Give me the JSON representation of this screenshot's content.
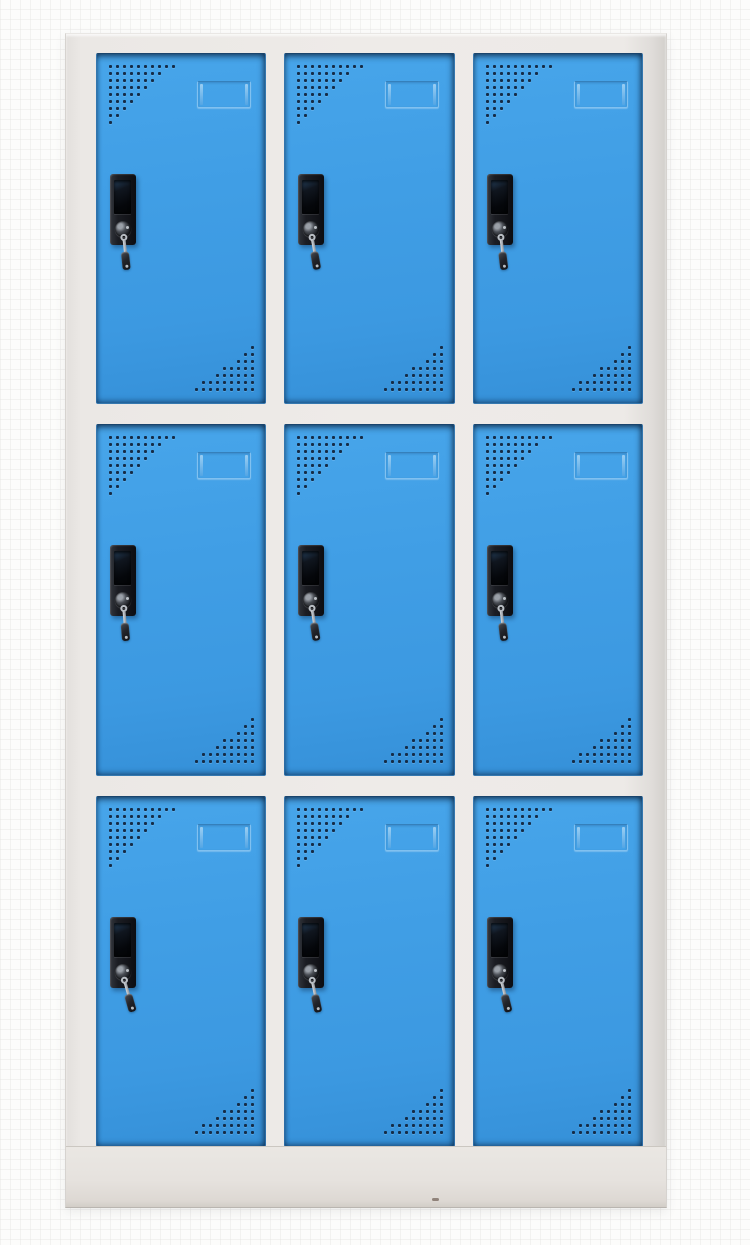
{
  "meta": {
    "description": "Product photo of a light-gray steel locker cabinet with nine bright blue doors arranged in a 3x3 grid. Each door has a triangular grille of ventilation perforations in its top-left and bottom-right corners, an embossed label-card holder near the top, and a black cam lock with a key hanging from the keyhole. The cabinet stands on a plain gray plinth against a white background.",
    "scene_type": "product-photo",
    "object": "nine-door steel locker cabinet"
  },
  "colors": {
    "background": "#fcfcfb",
    "frame": "#ebe8e5",
    "frame_edge": "#d3d0cc",
    "door_blue": "#3e9ce2",
    "door_blue_light": "#47a5ea",
    "door_blue_dark": "#3590d8",
    "door_edge_shadow": "#102c4c",
    "perforation": "#152c47",
    "card_holder_emboss": "#d7ebfa",
    "lock_body": "#17181d",
    "lock_window": "#05070b",
    "key_metal": "#c9ced4",
    "key_head": "#23252b",
    "base": "#e6e2de",
    "base_edge": "#b9b5b0"
  },
  "cabinet": {
    "rows": 3,
    "columns": 3,
    "door_count": 9,
    "vent_pattern": {
      "top_left_rows": [
        10,
        8,
        7,
        6,
        5,
        4,
        3,
        2,
        1
      ],
      "bottom_right_rows": [
        1,
        2,
        3,
        5,
        6,
        8,
        9
      ]
    },
    "components_per_door": [
      "vent-grille-top-left",
      "label-card-holder",
      "cam-lock",
      "lock-handle-recess",
      "keyhole",
      "hanging-key",
      "vent-grille-bottom-right"
    ],
    "doors": [
      {
        "id": "door-1",
        "row": 1,
        "column": 1,
        "key_angle": -6
      },
      {
        "id": "door-2",
        "row": 1,
        "column": 2,
        "key_angle": -10
      },
      {
        "id": "door-3",
        "row": 1,
        "column": 3,
        "key_angle": -7
      },
      {
        "id": "door-4",
        "row": 2,
        "column": 1,
        "key_angle": -5
      },
      {
        "id": "door-5",
        "row": 2,
        "column": 2,
        "key_angle": -9
      },
      {
        "id": "door-6",
        "row": 2,
        "column": 3,
        "key_angle": -7
      },
      {
        "id": "door-7",
        "row": 3,
        "column": 1,
        "key_angle": -16
      },
      {
        "id": "door-8",
        "row": 3,
        "column": 2,
        "key_angle": -12
      },
      {
        "id": "door-9",
        "row": 3,
        "column": 3,
        "key_angle": -14
      }
    ]
  }
}
